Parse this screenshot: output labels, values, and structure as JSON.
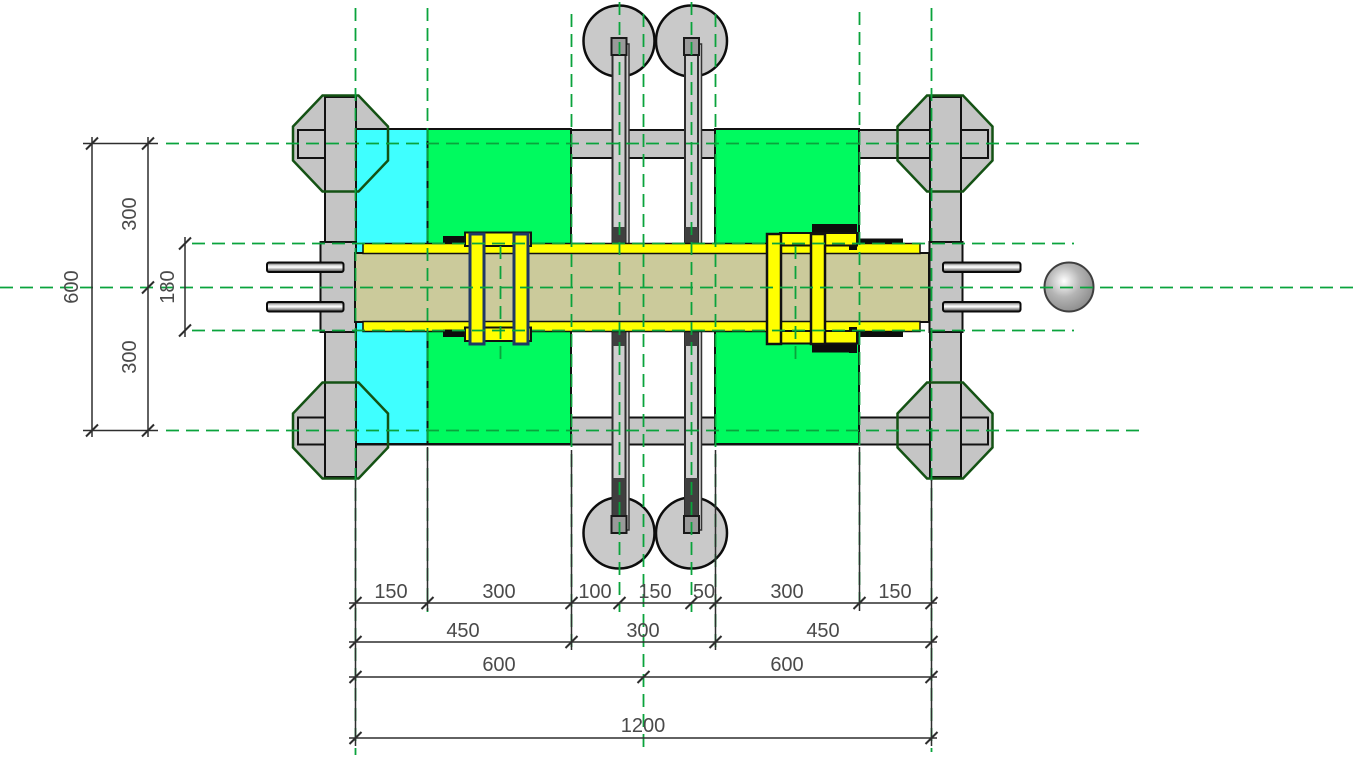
{
  "dimensions": {
    "bottom_rows": {
      "row1": [
        "150",
        "300",
        "100",
        "150",
        "50",
        "300",
        "150"
      ],
      "row2": [
        "450",
        "300",
        "450"
      ],
      "row3": [
        "600",
        "600"
      ],
      "row4": [
        "1200"
      ]
    },
    "left": {
      "total": "600",
      "upper": "300",
      "lower": "300",
      "beam_height": "180"
    }
  },
  "colors": {
    "background": "#ffffff",
    "cyan-block": "#3fffff",
    "green-block": "#00fa5f",
    "beam-tan": "#cbca9b",
    "plate-yellow": "#ffff00",
    "steel-gray": "#c5c5c5",
    "roller-gray": "#c9c9c9",
    "outline-black": "#111111",
    "clamp-navy": "#1f3864",
    "octagon-green": "#145214",
    "centerline-green": "#0aa33c",
    "dim-line": "#2e2e2e",
    "dim-text": "#4a4a4a"
  }
}
